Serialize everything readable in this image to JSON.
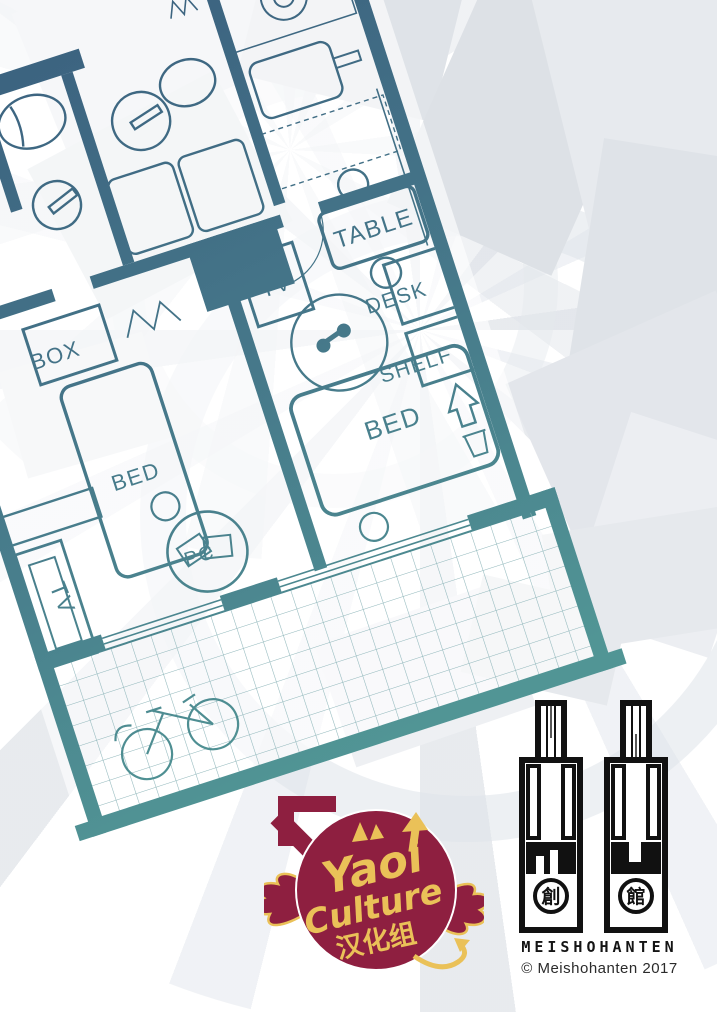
{
  "colors": {
    "wall_top": "#3a5f7e",
    "wall_mid": "#457689",
    "wall_bottom": "#519595",
    "logo_maroon": "#8e1f40",
    "logo_yellow": "#eac158",
    "ink": "#111111"
  },
  "floorplan": {
    "labels": {
      "table": "TABLE",
      "box": "BOX",
      "tv_small": "TV",
      "bed_large": "BED",
      "bed_small": "BED",
      "desk": "DESK",
      "shelf": "SHELF",
      "tv_stand": "TV",
      "pc": "PC"
    }
  },
  "logo": {
    "word1": "Yaoi",
    "word2": "Culture",
    "word3": "汉化组"
  },
  "publisher": {
    "name": "MEISHOHANTEN",
    "copyright": "© Meishohanten 2017",
    "seal_left": "創",
    "seal_right": "館"
  }
}
